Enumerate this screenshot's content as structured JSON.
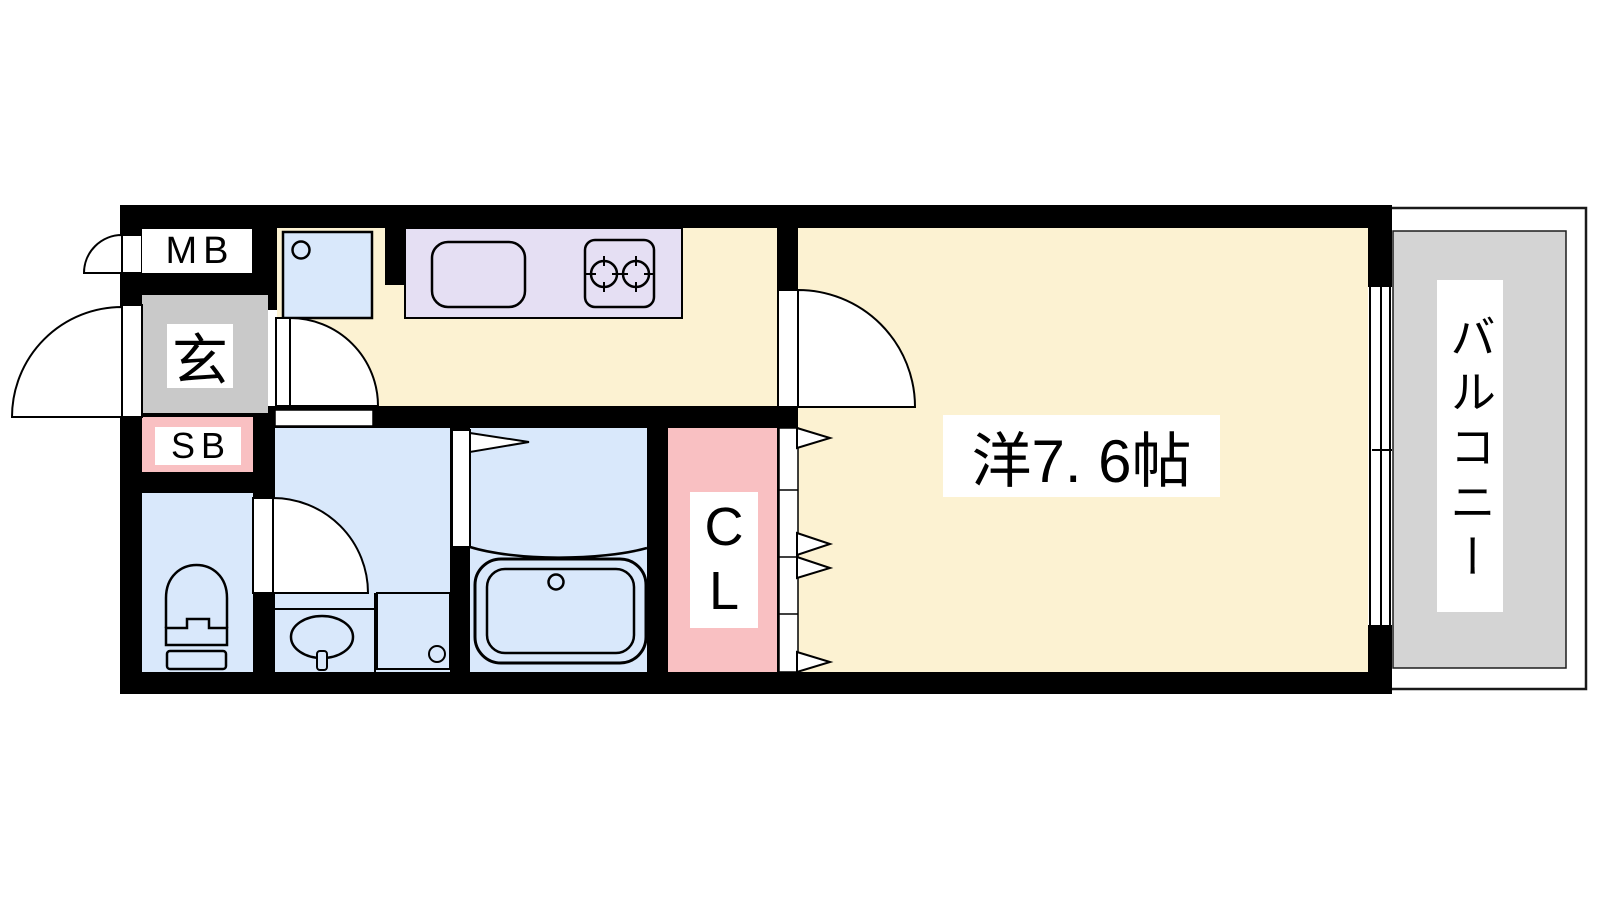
{
  "floorplan": {
    "labels": {
      "meter_box": "MB",
      "entrance": "玄",
      "shoe_box": "SB",
      "closet": "C\nL",
      "main_room": "洋7. 6帖",
      "balcony": "バルコニー"
    },
    "colors": {
      "wall": "#000000",
      "floor_cream": "#FCF2D2",
      "wet_blue": "#D9E8FB",
      "kitchen_lavender": "#E5DFF3",
      "storage_pink": "#F9C0C2",
      "genkan_gray": "#C9C9C9",
      "balcony_gray": "#D4D4D4"
    }
  }
}
